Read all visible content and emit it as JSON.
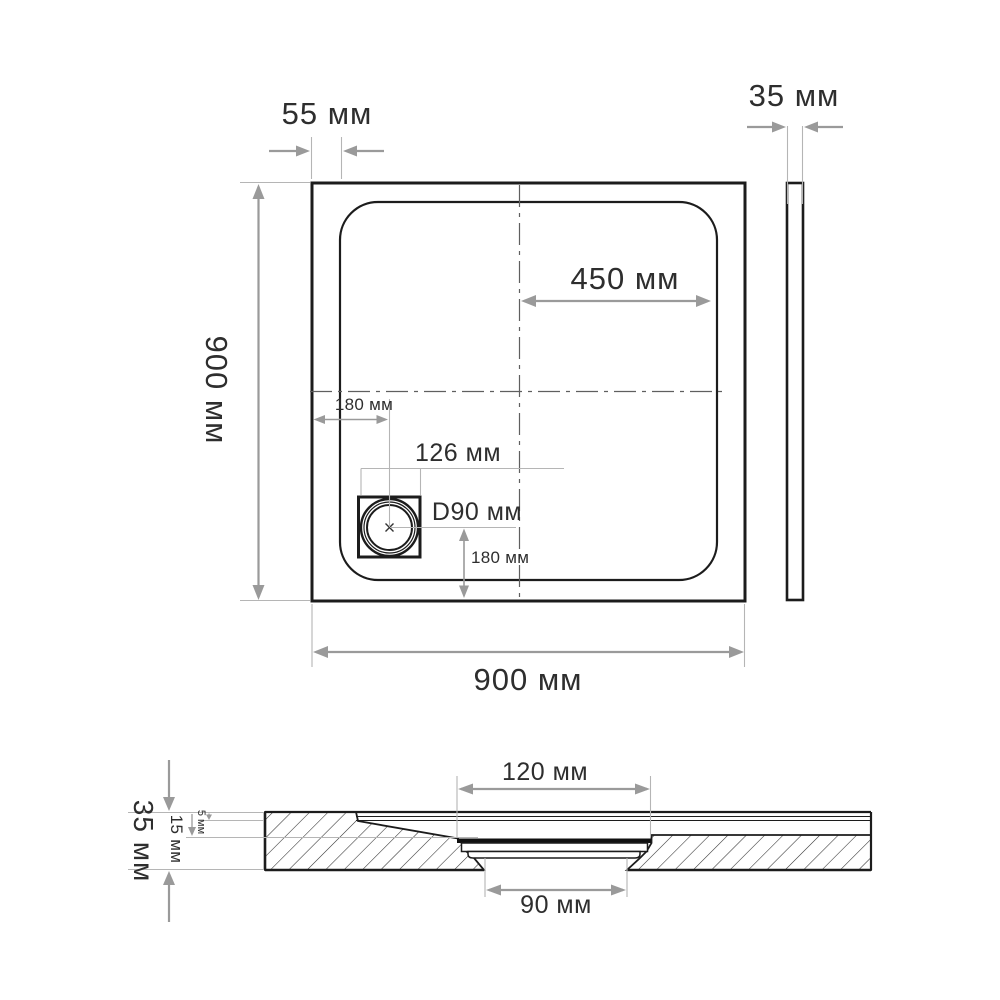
{
  "drawing": {
    "title": "Shower tray dimensional drawing",
    "units": "мм",
    "colors": {
      "outline": "#1c1c1c",
      "dimension": "#9a9a9a",
      "extension": "#b5b5b5",
      "centerline": "#5f5f5f",
      "text": "#2e2e2e",
      "background": "#ffffff"
    },
    "top_view": {
      "dim_rim": "55 мм",
      "dim_thickness": "35 мм",
      "dim_half_width": "450 мм",
      "dim_height": "900 мм",
      "dim_width": "900 мм",
      "dim_drain_from_left": "180 мм",
      "dim_drain_plate": "126 мм",
      "dim_drain_diameter": "D90 мм",
      "dim_drain_from_bottom": "180 мм"
    },
    "section_view": {
      "dim_total_height": "35 мм",
      "dim_inner_depth": "15 мм",
      "dim_floor_thickness": "5 мм",
      "dim_flange_width": "120 мм",
      "dim_outlet_width": "90 мм"
    }
  }
}
